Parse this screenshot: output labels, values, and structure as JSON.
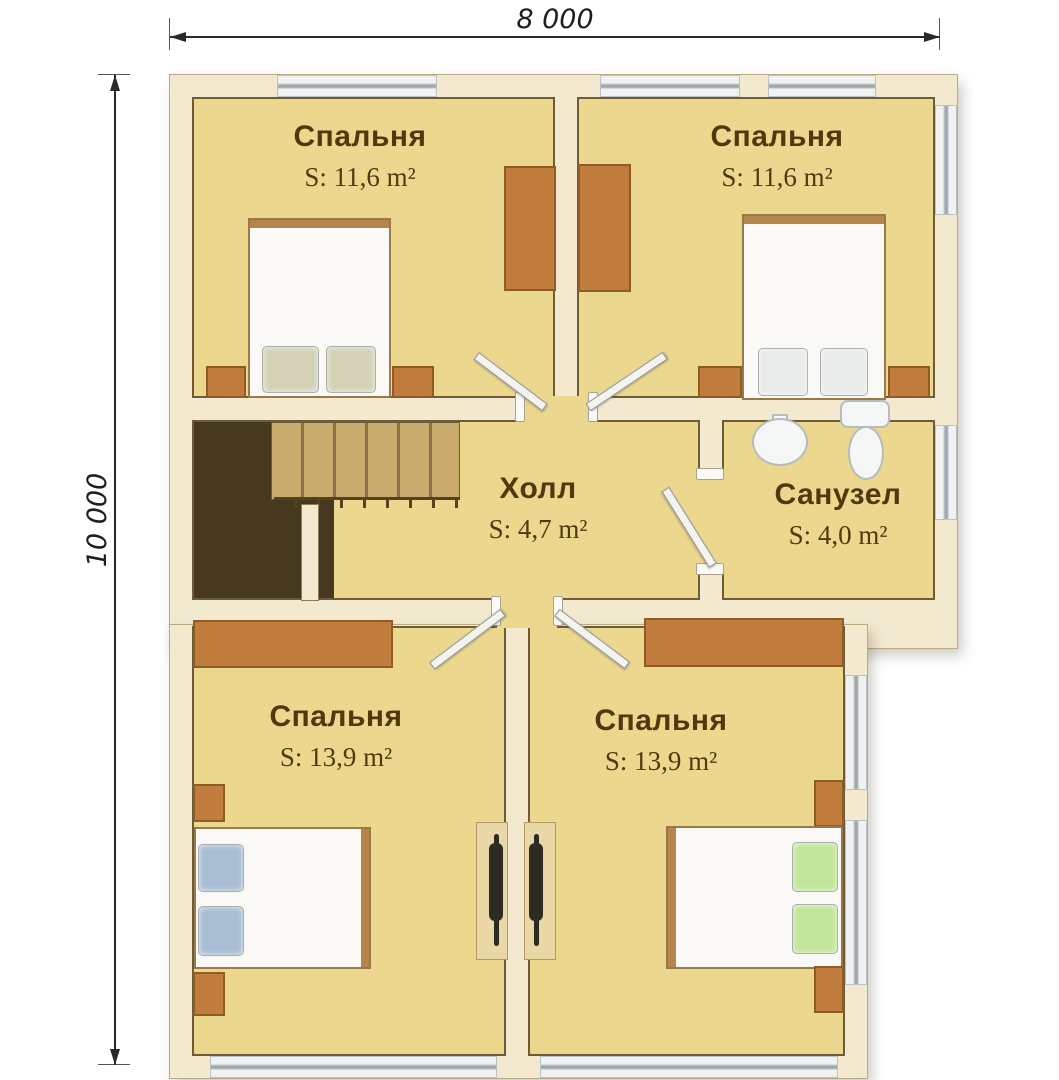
{
  "plan": {
    "dimension_width": "8 000",
    "dimension_height": "10 000",
    "rooms": [
      {
        "name": "Спальня",
        "area": "S: 11,6 m²"
      },
      {
        "name": "Спальня",
        "area": "S: 11,6 m²"
      },
      {
        "name": "Холл",
        "area": "S: 4,7 m²"
      },
      {
        "name": "Санузел",
        "area": "S: 4,0 m²"
      },
      {
        "name": "Спальня",
        "area": "S: 13,9 m²"
      },
      {
        "name": "Спальня",
        "area": "S: 13,9 m²"
      }
    ],
    "colors": {
      "floor": "#ecd78e",
      "wall": "#f2e9cf",
      "wall_edge": "#6e5c38",
      "wood": "#c07d3e",
      "text": "#4e3a0e",
      "pillow_beige": "#d3d2b6",
      "pillow_white": "#e9ebea",
      "pillow_blue": "#a9bdd3",
      "pillow_green": "#c3e59a",
      "stair_void": "#47391f",
      "stair_tread": "#c9ab6e"
    },
    "fixtures": [
      "double-bed",
      "wardrobe",
      "nightstand",
      "desk",
      "chair",
      "stairs",
      "toilet",
      "sink",
      "window",
      "door"
    ]
  }
}
